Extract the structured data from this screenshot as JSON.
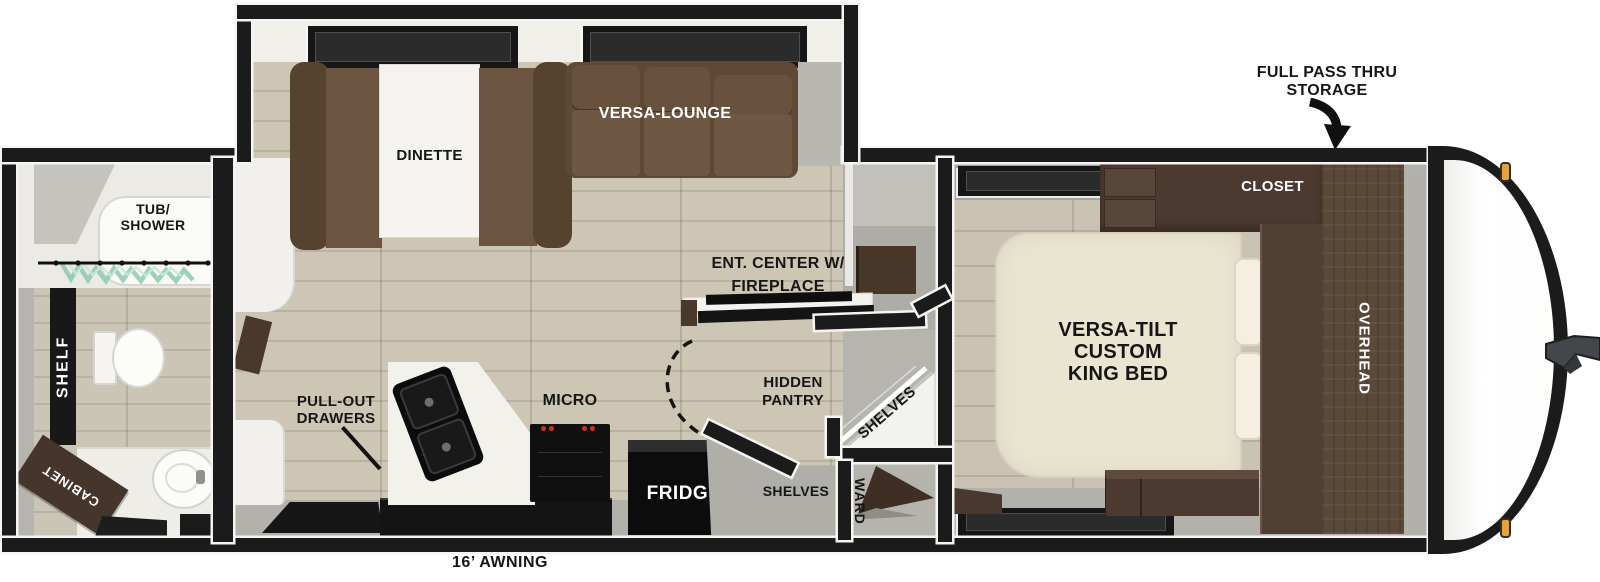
{
  "title": "Travel trailer floor plan",
  "colors": {
    "wall": "#1b1b1b",
    "floor_wood": "#cbc4b2",
    "sofa_brown": "#6b5540",
    "cabinet_wood": "#4c3a30",
    "bed_cream": "#eae5d1",
    "marker_light_orange": "#e6a33c",
    "label_black": "#161616",
    "label_white": "#ffffff"
  },
  "exterior": {
    "storage_line1": "FULL PASS THRU",
    "storage_line2": "STORAGE",
    "awning": "16’ AWNING"
  },
  "bathroom": {
    "tub_line1": "TUB/",
    "tub_line2": "SHOWER",
    "shelf": "SHELF",
    "cabinet": "CABINET"
  },
  "slideout": {
    "dinette": "DINETTE",
    "lounge": "VERSA-LOUNGE"
  },
  "kitchen": {
    "drawers_line1": "PULL-OUT",
    "drawers_line2": "DRAWERS",
    "micro": "MICRO",
    "fridge": "FRIDGE"
  },
  "living": {
    "ent_line1": "ENT. CENTER W/",
    "ent_line2": "FIREPLACE"
  },
  "pantry": {
    "hidden_line1": "HIDDEN",
    "hidden_line2": "PANTRY",
    "shelves_corner": "SHELVES",
    "shelves_entry": "SHELVES",
    "ward": "WARD"
  },
  "bedroom": {
    "bed_line1": "VERSA-TILT",
    "bed_line2": "CUSTOM",
    "bed_line3": "KING BED",
    "closet": "CLOSET",
    "overhead": "OVERHEAD"
  }
}
